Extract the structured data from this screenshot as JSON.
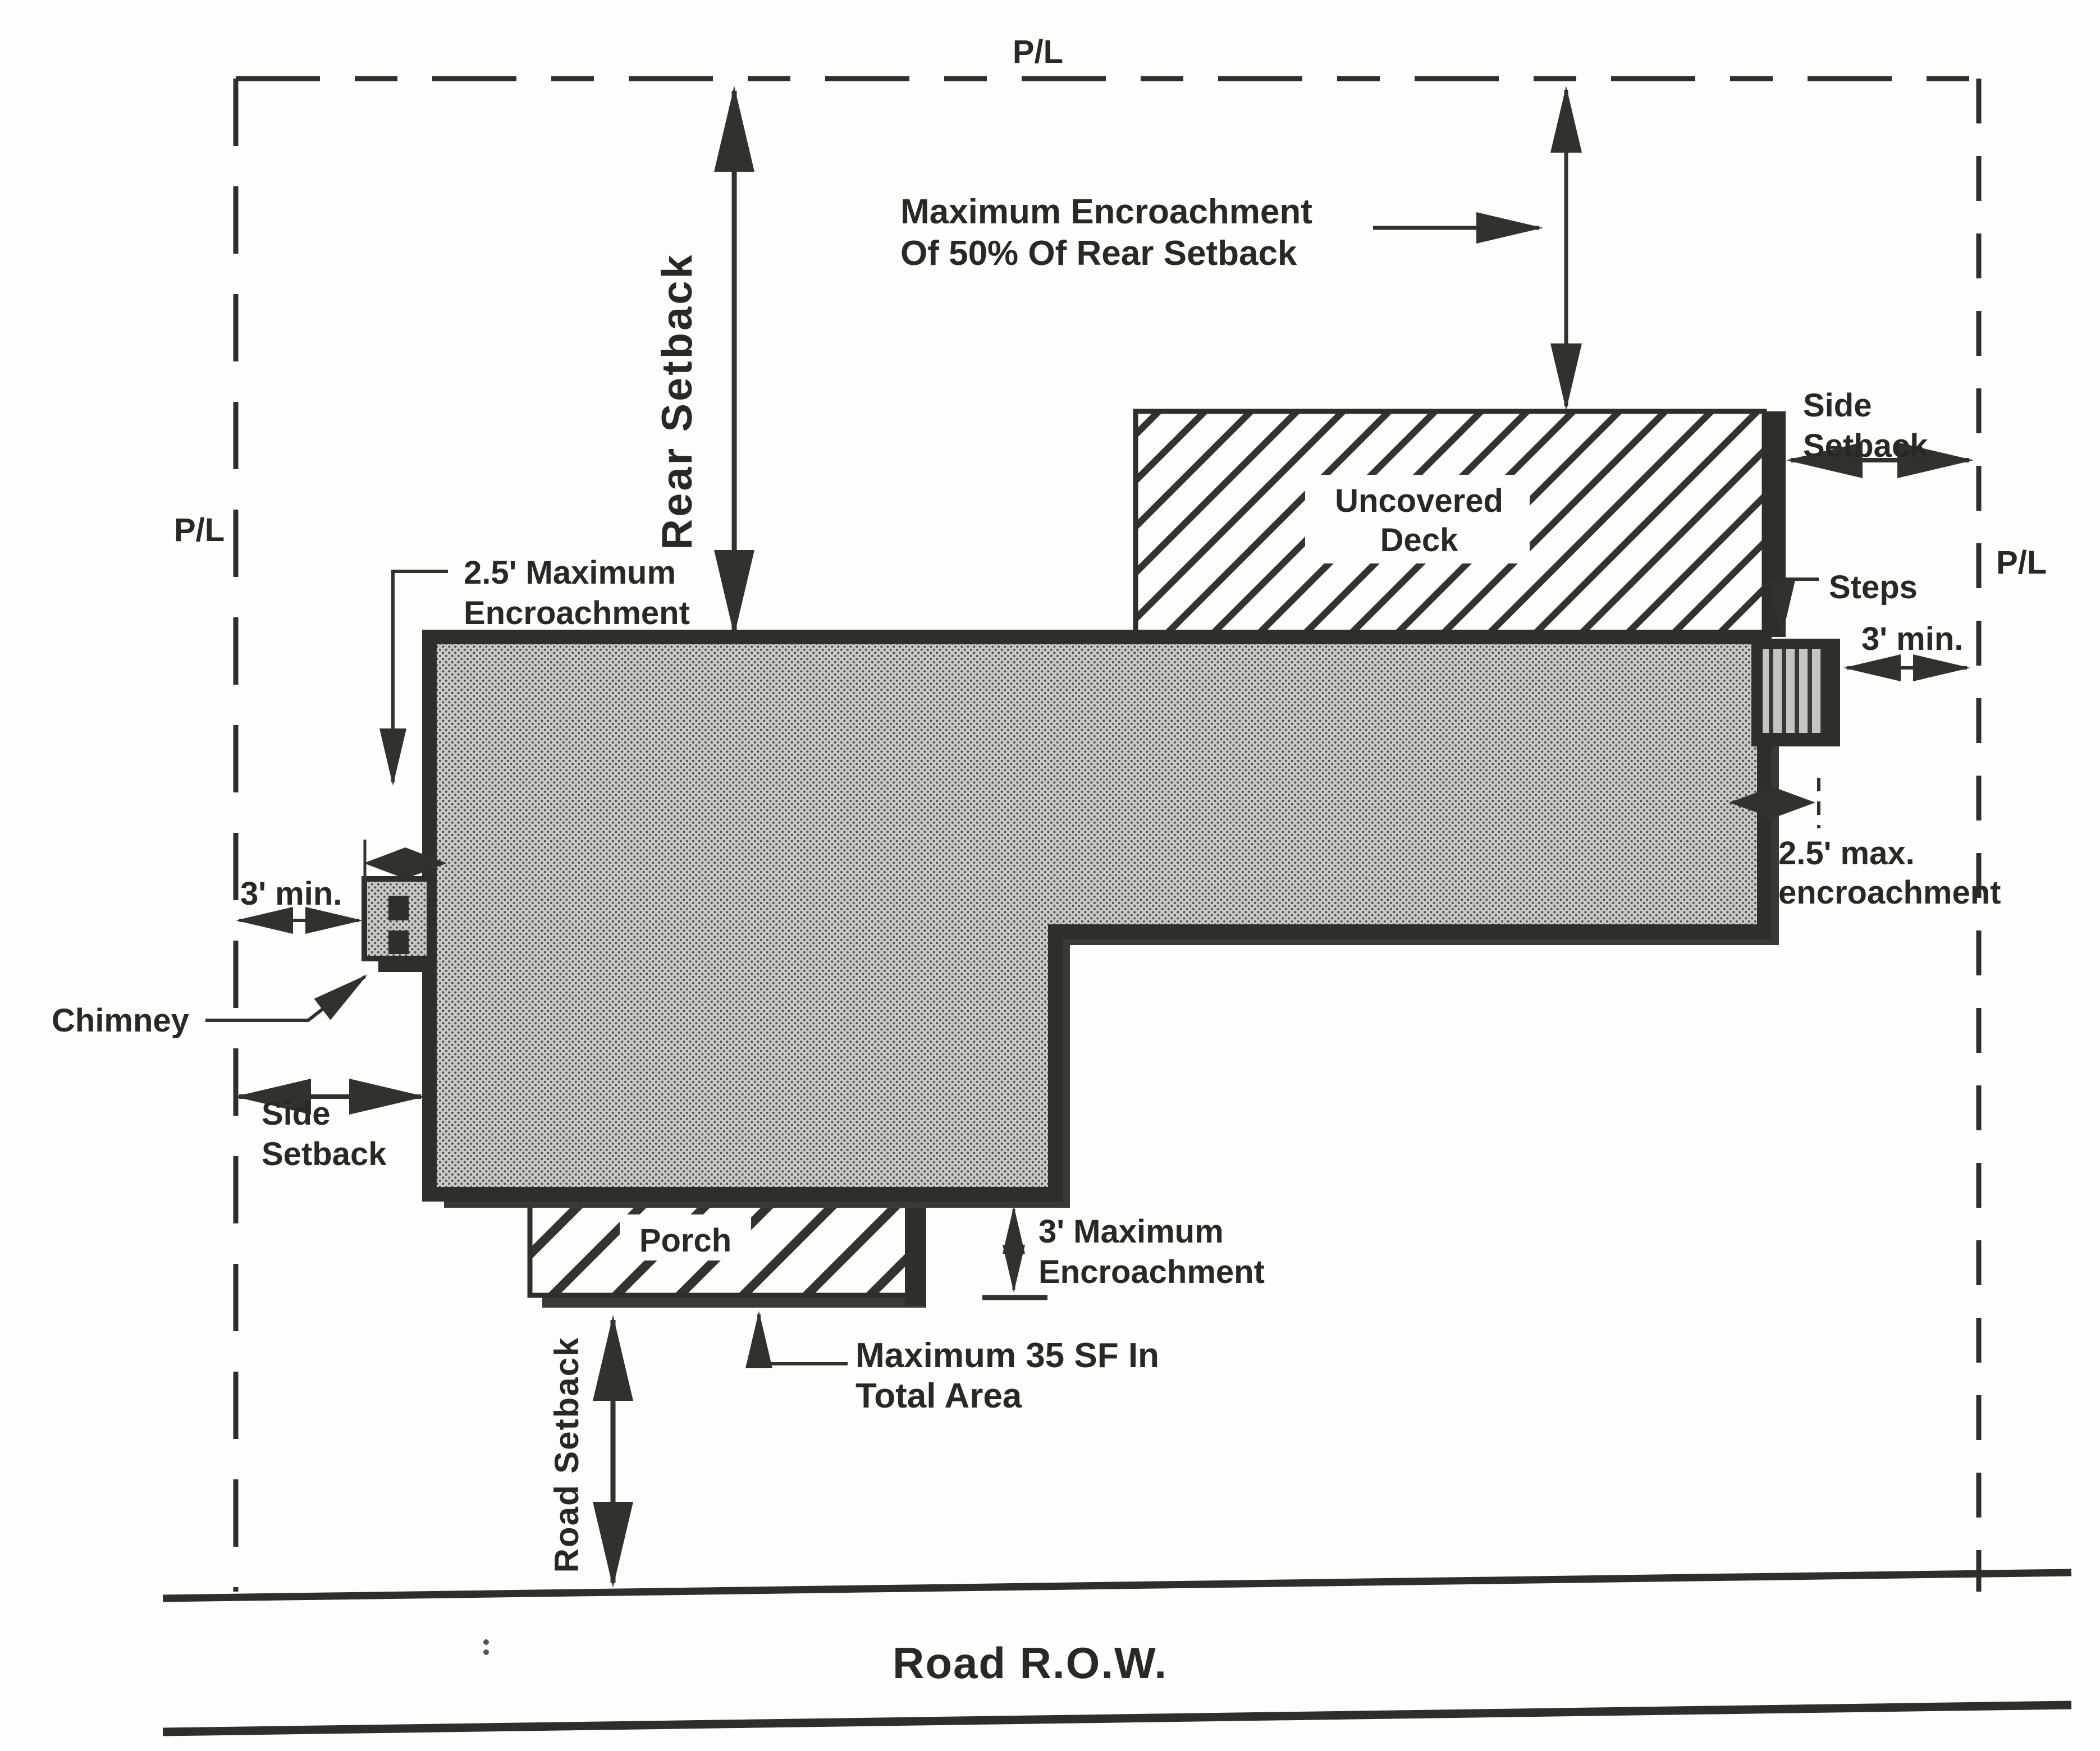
{
  "diagram_type": "residential setback and encroachment site plan",
  "colors": {
    "ink": "#2f2e2b",
    "paper": "#fdfdfb",
    "building_fill": "#cac9c5",
    "shadow": "#3a3935",
    "text": "#292824"
  },
  "labels": {
    "property_line_top": "P/L",
    "property_line_left": "P/L",
    "property_line_right": "P/L",
    "rear_setback": "Rear Setback",
    "rear_max_encroachment_line1": "Maximum Encroachment",
    "rear_max_encroachment_line2": "Of 50% Of Rear Setback",
    "side_setback_right_line1": "Side",
    "side_setback_right_line2": "Setback",
    "uncovered_deck_line1": "Uncovered",
    "uncovered_deck_line2": "Deck",
    "steps": "Steps",
    "min_3ft_right": "3' min.",
    "max_encroachment_right_line1": "2.5' max.",
    "max_encroachment_right_line2": "encroachment",
    "max_encroachment_left_line1": "2.5' Maximum",
    "max_encroachment_left_line2": "Encroachment",
    "min_3ft_left": "3' min.",
    "chimney": "Chimney",
    "side_setback_left_line1": "Side",
    "side_setback_left_line2": "Setback",
    "porch": "Porch",
    "porch_encroachment_line1": "3' Maximum",
    "porch_encroachment_line2": "Encroachment",
    "porch_area_line1": "Maximum 35 SF In",
    "porch_area_line2": "Total Area",
    "road_setback": "Road Setback",
    "road_row": "Road R.O.W."
  }
}
